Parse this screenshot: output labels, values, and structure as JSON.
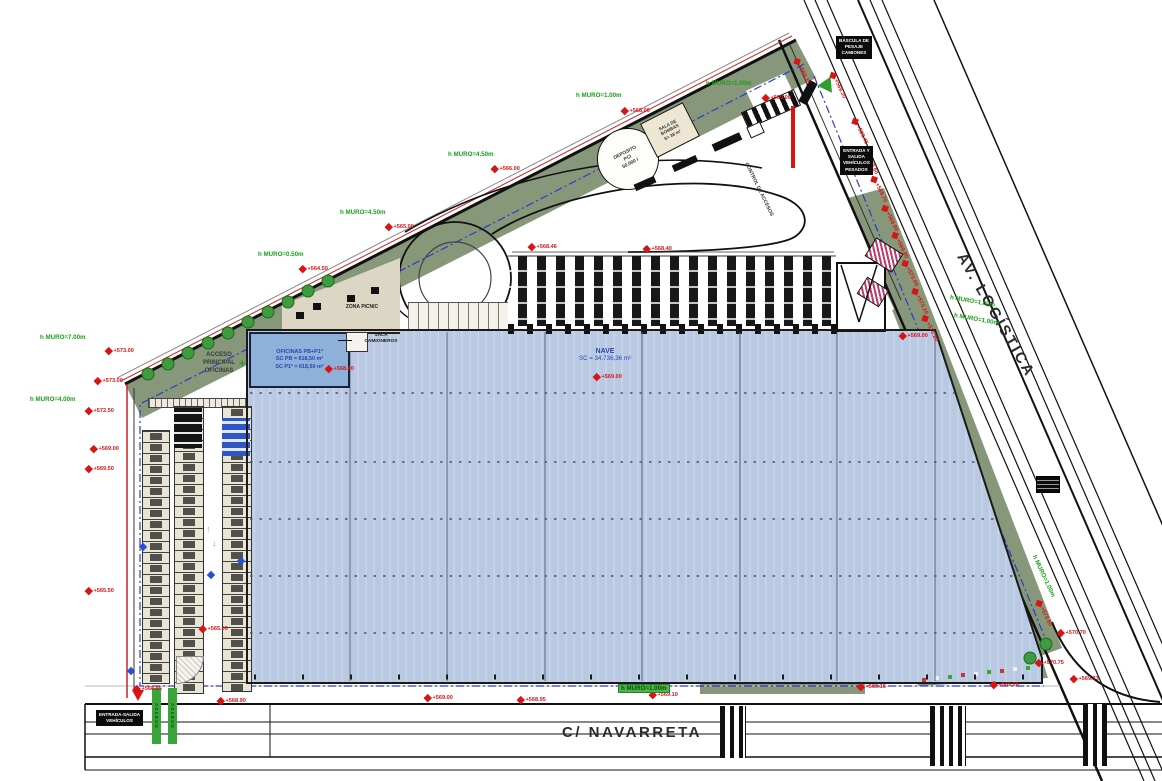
{
  "drawing": {
    "street_bottom": "C/ NAVARRETA",
    "avenue_right": "AV. LOGÍSTICA",
    "nave": {
      "name": "NAVE",
      "area": "SC = 34.736,36 m²"
    },
    "offices": {
      "l1": "OFICINAS PB+P1ª",
      "l2": "SC PB = 618,50 m²",
      "l3": "SC P1ª = 618,50 m²"
    },
    "acceso_principal": {
      "l1": "ACCESO",
      "l2": "PRINCIPAL",
      "l3": "OFICINAS"
    },
    "sala_camioneros": {
      "l1": "SALA",
      "l2": "CAMIONEROS"
    },
    "zona_picnic": "ZONA PICNIC",
    "deposito": {
      "l1": "DEPOSITO",
      "l2": "PCI",
      "l3": "50.000 l"
    },
    "sala_bombas": {
      "l1": "SALA DE",
      "l2": "BOMBAS",
      "l3": "S= 38 m²"
    },
    "control_accesos": "CONTROL DE ACCESOS",
    "crosswalk_label": "ACCESO"
  },
  "colors": {
    "wall_label_green": "#17a017",
    "elevation_red": "#d81414",
    "band_olive": "#87977a",
    "building_blue": "#bac9e2",
    "offices_blue": "#8fb0d8",
    "boundary_blue_dash": "#2b3bd0"
  },
  "wall_labels": [
    {
      "x": 576,
      "y": 92,
      "r": 0,
      "t": "h MURO=1.00m"
    },
    {
      "x": 448,
      "y": 151,
      "r": 0,
      "t": "h MURO=4.50m"
    },
    {
      "x": 340,
      "y": 209,
      "r": 0,
      "t": "h MURO=4.50m"
    },
    {
      "x": 258,
      "y": 251,
      "r": 0,
      "t": "h MURO=0.50m"
    },
    {
      "x": 40,
      "y": 334,
      "r": 0,
      "t": "h MURO=7.00m"
    },
    {
      "x": 30,
      "y": 396,
      "r": 0,
      "t": "h MURO=4.00m"
    },
    {
      "x": 706,
      "y": 80,
      "r": 0,
      "t": "h MURO=1.00m"
    },
    {
      "x": 950,
      "y": 294,
      "r": 10,
      "t": "h MURO=1.00m"
    },
    {
      "x": 954,
      "y": 312,
      "r": 10,
      "t": "h MURO=1.00m"
    },
    {
      "x": 1034,
      "y": 552,
      "r": 65,
      "t": "h MURO=1.00m"
    },
    {
      "x": 618,
      "y": 684,
      "r": 0,
      "t": "h MURO=1.00m",
      "badge": true
    }
  ],
  "elevation_markers": [
    {
      "x": 622,
      "y": 108,
      "v": "+568.00"
    },
    {
      "x": 492,
      "y": 166,
      "v": "+566.00"
    },
    {
      "x": 386,
      "y": 224,
      "v": "+565.00"
    },
    {
      "x": 300,
      "y": 266,
      "v": "+564.50"
    },
    {
      "x": 763,
      "y": 95,
      "v": "+569.00"
    },
    {
      "x": 106,
      "y": 348,
      "v": "+573.00"
    },
    {
      "x": 95,
      "y": 378,
      "v": "+573.00"
    },
    {
      "x": 86,
      "y": 408,
      "v": "+572.50"
    },
    {
      "x": 91,
      "y": 446,
      "v": "+569.00"
    },
    {
      "x": 86,
      "y": 466,
      "v": "+569.50"
    },
    {
      "x": 86,
      "y": 588,
      "v": "+565.50"
    },
    {
      "x": 200,
      "y": 626,
      "v": "+565.00"
    },
    {
      "x": 326,
      "y": 366,
      "v": "+568.00"
    },
    {
      "x": 594,
      "y": 374,
      "v": "+569.00"
    },
    {
      "x": 529,
      "y": 244,
      "v": "+568.46"
    },
    {
      "x": 644,
      "y": 246,
      "v": "+568.40"
    },
    {
      "x": 900,
      "y": 333,
      "v": "+569.00"
    },
    {
      "x": 796,
      "y": 56,
      "v": "+569.15",
      "r": 64
    },
    {
      "x": 832,
      "y": 70,
      "v": "+569.30",
      "r": 64
    },
    {
      "x": 854,
      "y": 116,
      "v": "+569.45",
      "r": 64
    },
    {
      "x": 864,
      "y": 146,
      "v": "+569.60",
      "r": 64
    },
    {
      "x": 873,
      "y": 174,
      "v": "+569.70",
      "r": 64
    },
    {
      "x": 884,
      "y": 203,
      "v": "+569.80",
      "r": 64
    },
    {
      "x": 894,
      "y": 230,
      "v": "+569.90",
      "r": 64
    },
    {
      "x": 904,
      "y": 258,
      "v": "+570.00",
      "r": 64
    },
    {
      "x": 914,
      "y": 286,
      "v": "+570.10",
      "r": 64
    },
    {
      "x": 924,
      "y": 313,
      "v": "+570.20",
      "r": 64
    },
    {
      "x": 1038,
      "y": 598,
      "v": "+570.60",
      "r": 64
    },
    {
      "x": 1058,
      "y": 630,
      "v": "+570.70"
    },
    {
      "x": 1036,
      "y": 660,
      "v": "+570.75"
    },
    {
      "x": 425,
      "y": 695,
      "v": "+569.00"
    },
    {
      "x": 518,
      "y": 697,
      "v": "+568.95"
    },
    {
      "x": 650,
      "y": 692,
      "v": "+569.10"
    },
    {
      "x": 858,
      "y": 684,
      "v": "+569.16"
    },
    {
      "x": 991,
      "y": 682,
      "v": "+569.26"
    },
    {
      "x": 1071,
      "y": 676,
      "v": "+569.73"
    },
    {
      "x": 218,
      "y": 698,
      "v": "+568.90"
    },
    {
      "x": 134,
      "y": 686,
      "v": "+568.85"
    }
  ],
  "chips": [
    {
      "x": 836,
      "y": 36,
      "lines": [
        "BÁSCULA DE",
        "PESAJE",
        "CAMIONES"
      ]
    },
    {
      "x": 840,
      "y": 146,
      "lines": [
        "ENTRADA Y",
        "SALIDA",
        "VEHÍCULOS",
        "PESADOS"
      ]
    },
    {
      "x": 96,
      "y": 710,
      "lines": [
        "ENTRADA-SALIDA",
        "VEHÍCULOS"
      ]
    }
  ]
}
